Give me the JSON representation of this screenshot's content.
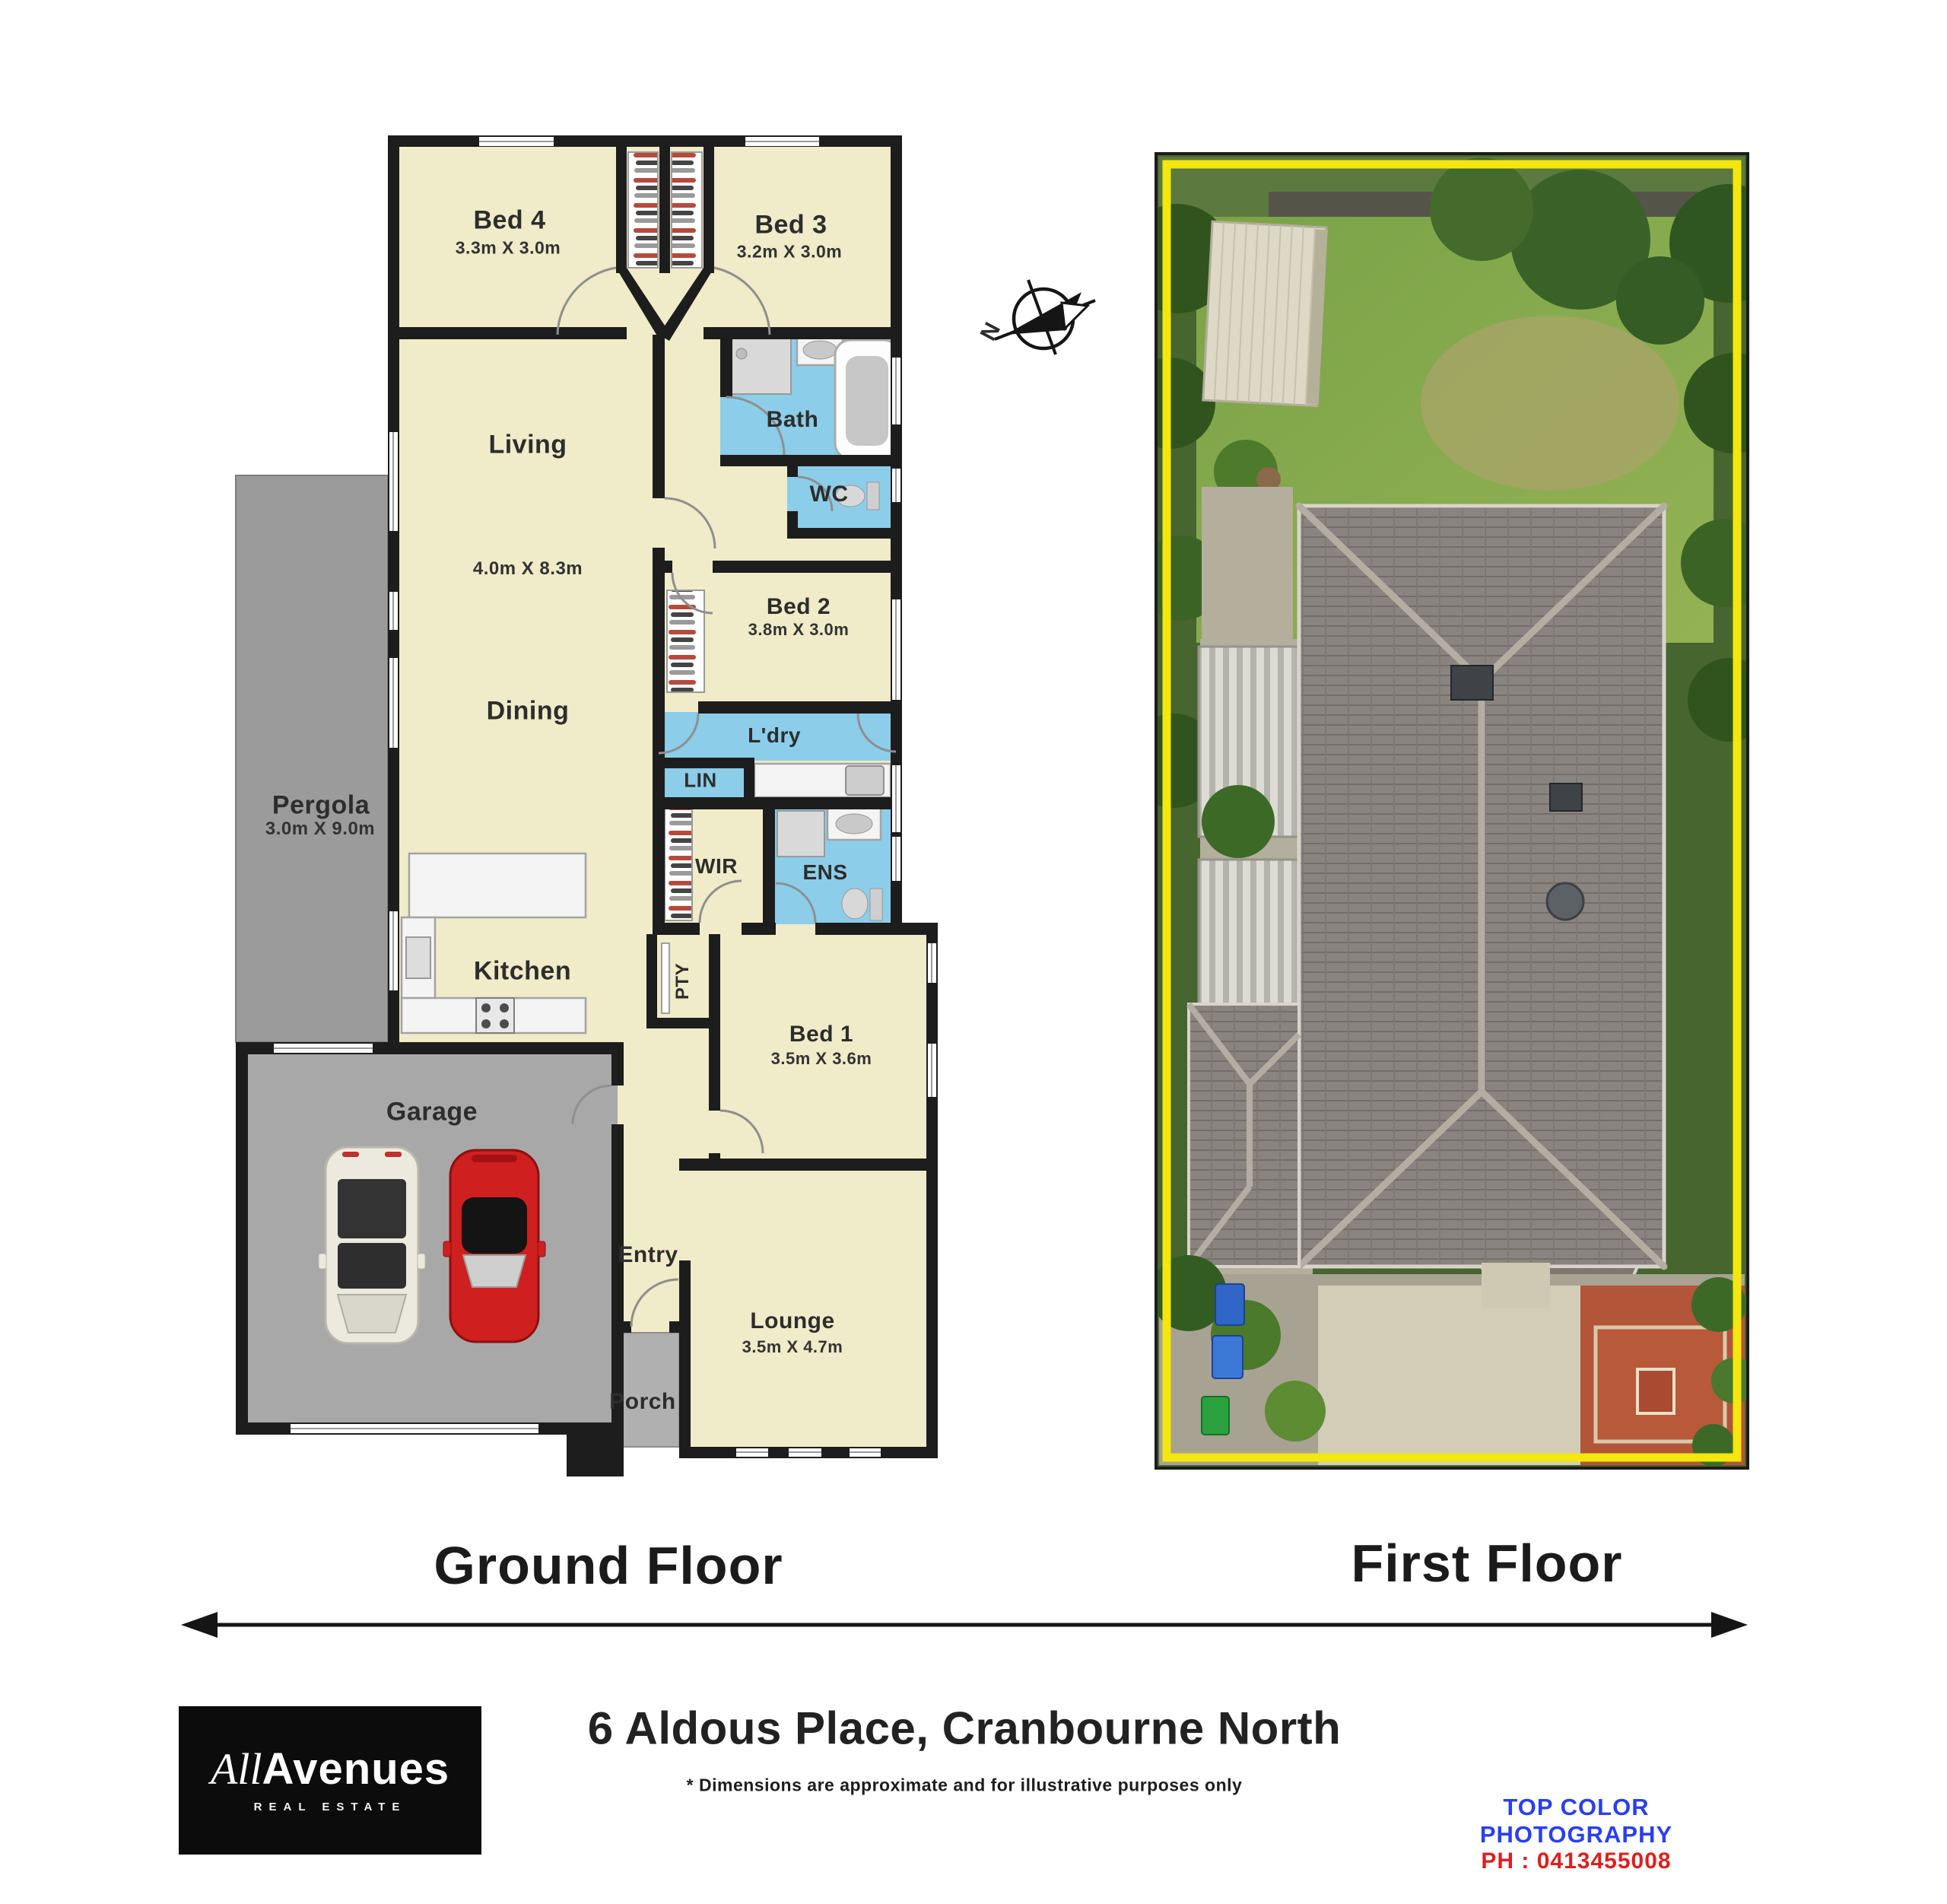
{
  "floor_plan": {
    "title": "Ground Floor",
    "compass_label": "N",
    "rooms": {
      "bed4": {
        "label": "Bed 4",
        "dims": "3.3m X 3.0m"
      },
      "bed3": {
        "label": "Bed 3",
        "dims": "3.2m X 3.0m"
      },
      "bath": {
        "label": "Bath"
      },
      "wc": {
        "label": "WC"
      },
      "living": {
        "label": "Living",
        "dims": "4.0m X 8.3m"
      },
      "dining": {
        "label": "Dining"
      },
      "bed2": {
        "label": "Bed 2",
        "dims": "3.8m X 3.0m"
      },
      "laundry": {
        "label": "L'dry"
      },
      "linen": {
        "label": "LIN"
      },
      "wir": {
        "label": "WIR"
      },
      "ens": {
        "label": "ENS"
      },
      "kitchen": {
        "label": "Kitchen"
      },
      "pantry": {
        "label": "PTY"
      },
      "bed1": {
        "label": "Bed 1",
        "dims": "3.5m X 3.6m"
      },
      "entry": {
        "label": "Entry"
      },
      "lounge": {
        "label": "Lounge",
        "dims": "3.5m X 4.7m"
      },
      "porch": {
        "label": "Porch"
      },
      "garage": {
        "label": "Garage"
      },
      "pergola": {
        "label": "Pergola",
        "dims": "3.0m X 9.0m"
      }
    }
  },
  "photo": {
    "title": "First Floor"
  },
  "footer": {
    "address": "6 Aldous Place, Cranbourne North",
    "disclaimer": "* Dimensions are approximate and for illustrative purposes only",
    "credit_line1": "TOP COLOR PHOTOGRAPHY",
    "credit_line2": "PH : 0413455008",
    "logo": {
      "part1": "All",
      "part2": "Avenues",
      "tagline": "REAL ESTATE"
    }
  },
  "colors": {
    "wall": "#1d1d1d",
    "room_cream": "#f0ebc8",
    "wet_blue": "#8ccde9",
    "pergola_gray": "#9b9b9b",
    "garage_gray": "#a8a8a8",
    "porch_gray": "#b0b0b0",
    "boundary_yellow": "#f3e70d",
    "credit_blue": "#2a3ff0",
    "credit_red": "#dd1f1f",
    "logo_black": "#0c0c0c"
  }
}
